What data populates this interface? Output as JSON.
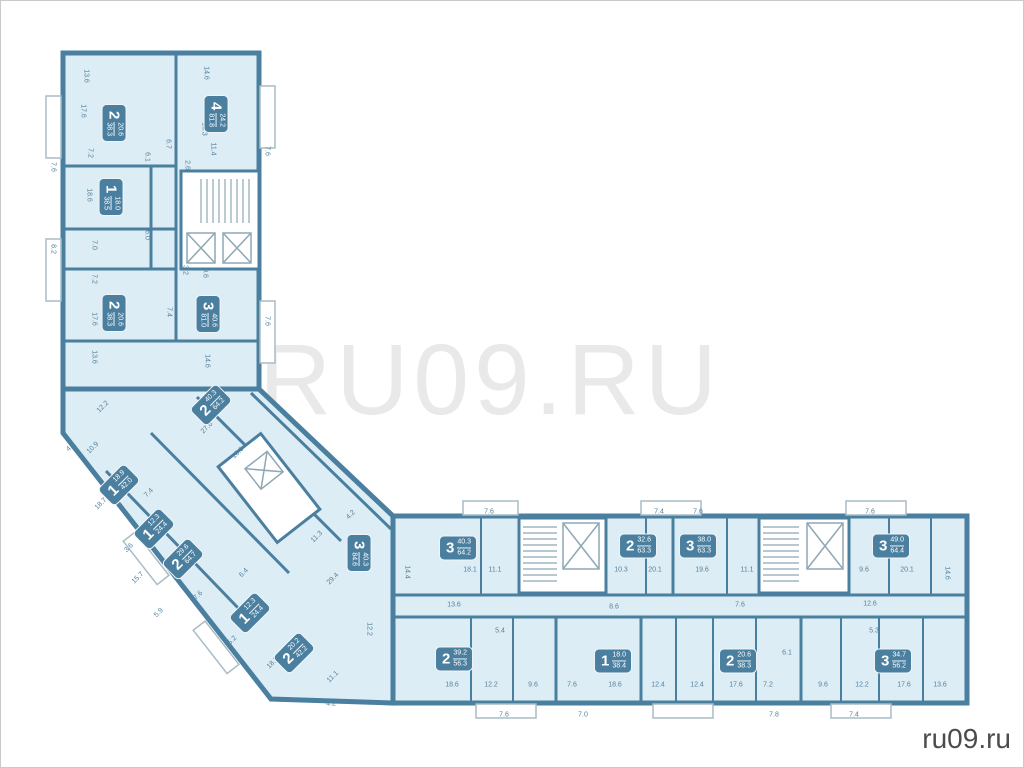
{
  "page": {
    "watermark": "RU09.RU",
    "site_label": "ru09.ru"
  },
  "colors": {
    "wall": "#4a7f9f",
    "apartment_fill": "#ddedf5",
    "badge_fill": "#4a7f9f",
    "badge_text": "#ffffff",
    "dimension_text": "#54809c",
    "balcony_stroke": "#a9bcc6",
    "watermark": "#e9e9e9",
    "site_text": "#4c4c4c"
  },
  "apartments": [
    {
      "rooms": "2",
      "a1": "20.6",
      "a2": "38.3",
      "x": 113,
      "y": 122,
      "rot": 90
    },
    {
      "rooms": "4",
      "a1": "24.2",
      "a2": "81.8",
      "x": 215,
      "y": 113,
      "rot": 90
    },
    {
      "rooms": "1",
      "a1": "18.0",
      "a2": "38.5",
      "x": 110,
      "y": 196,
      "rot": 90
    },
    {
      "rooms": "2",
      "a1": "20.6",
      "a2": "38.3",
      "x": 113,
      "y": 312,
      "rot": 90
    },
    {
      "rooms": "3",
      "a1": "40.6",
      "a2": "81.0",
      "x": 207,
      "y": 313,
      "rot": 90
    },
    {
      "rooms": "2",
      "a1": "40.3",
      "a2": "64.2",
      "x": 210,
      "y": 404,
      "rot": -45
    },
    {
      "rooms": "1",
      "a1": "18.9",
      "a2": "42.0",
      "x": 118,
      "y": 484,
      "rot": -45
    },
    {
      "rooms": "1",
      "a1": "12.3",
      "a2": "24.4",
      "x": 153,
      "y": 528,
      "rot": -45
    },
    {
      "rooms": "2",
      "a1": "29.6",
      "a2": "64.7",
      "x": 182,
      "y": 558,
      "rot": -45
    },
    {
      "rooms": "1",
      "a1": "12.3",
      "a2": "24.4",
      "x": 249,
      "y": 612,
      "rot": -45
    },
    {
      "rooms": "2",
      "a1": "20.2",
      "a2": "42.2",
      "x": 293,
      "y": 652,
      "rot": -45
    },
    {
      "rooms": "3",
      "a1": "40.3",
      "a2": "84.6",
      "x": 358,
      "y": 552,
      "rot": 90
    },
    {
      "rooms": "3",
      "a1": "40.3",
      "a2": "64.2",
      "x": 457,
      "y": 547,
      "rot": 0
    },
    {
      "rooms": "2",
      "a1": "32.6",
      "a2": "63.3",
      "x": 637,
      "y": 545,
      "rot": 0
    },
    {
      "rooms": "3",
      "a1": "38.0",
      "a2": "63.3",
      "x": 697,
      "y": 545,
      "rot": 0
    },
    {
      "rooms": "3",
      "a1": "49.0",
      "a2": "64.4",
      "x": 890,
      "y": 545,
      "rot": 0
    },
    {
      "rooms": "2",
      "a1": "39.2",
      "a2": "56.3",
      "x": 453,
      "y": 658,
      "rot": 0
    },
    {
      "rooms": "1",
      "a1": "18.0",
      "a2": "38.4",
      "x": 612,
      "y": 660,
      "rot": 0
    },
    {
      "rooms": "2",
      "a1": "20.6",
      "a2": "38.3",
      "x": 737,
      "y": 660,
      "rot": 0
    },
    {
      "rooms": "3",
      "a1": "34.7",
      "a2": "56.2",
      "x": 892,
      "y": 660,
      "rot": 0
    }
  ],
  "room_labels": [
    {
      "text": "13.6",
      "x": 85,
      "y": 75,
      "rot": 90
    },
    {
      "text": "14.6",
      "x": 205,
      "y": 72,
      "rot": 90
    },
    {
      "text": "17.6",
      "x": 82,
      "y": 110,
      "rot": 90
    },
    {
      "text": "10.3",
      "x": 203,
      "y": 128,
      "rot": 90
    },
    {
      "text": "11.4",
      "x": 212,
      "y": 148,
      "rot": 90
    },
    {
      "text": "7.2",
      "x": 89,
      "y": 152,
      "rot": 90
    },
    {
      "text": "6.7",
      "x": 167,
      "y": 143,
      "rot": 90
    },
    {
      "text": "2.6",
      "x": 186,
      "y": 164,
      "rot": 90
    },
    {
      "text": "6.1",
      "x": 146,
      "y": 156,
      "rot": 90
    },
    {
      "text": "18.6",
      "x": 88,
      "y": 194,
      "rot": 90
    },
    {
      "text": "6.0",
      "x": 146,
      "y": 234,
      "rot": 90
    },
    {
      "text": "7.0",
      "x": 93,
      "y": 244,
      "rot": 90
    },
    {
      "text": "3.2",
      "x": 184,
      "y": 269,
      "rot": 90
    },
    {
      "text": "9.6",
      "x": 204,
      "y": 272,
      "rot": 90
    },
    {
      "text": "7.2",
      "x": 93,
      "y": 278,
      "rot": 90
    },
    {
      "text": "20.1",
      "x": 204,
      "y": 308,
      "rot": 90
    },
    {
      "text": "17.6",
      "x": 93,
      "y": 318,
      "rot": 90
    },
    {
      "text": "7.4",
      "x": 168,
      "y": 311,
      "rot": 90
    },
    {
      "text": "13.6",
      "x": 93,
      "y": 356,
      "rot": 90
    },
    {
      "text": "14.6",
      "x": 206,
      "y": 360,
      "rot": 90
    },
    {
      "text": "7.6",
      "x": 52,
      "y": 166,
      "rot": 90
    },
    {
      "text": "8.2",
      "x": 52,
      "y": 248,
      "rot": 90
    },
    {
      "text": "7.6",
      "x": 266,
      "y": 150,
      "rot": 90
    },
    {
      "text": "7.6",
      "x": 266,
      "y": 320,
      "rot": 90
    },
    {
      "text": "12.2",
      "x": 102,
      "y": 406,
      "rot": -45
    },
    {
      "text": "10.9",
      "x": 92,
      "y": 447,
      "rot": -45
    },
    {
      "text": "27.6",
      "x": 206,
      "y": 427,
      "rot": -45
    },
    {
      "text": "10.6",
      "x": 237,
      "y": 452,
      "rot": -45
    },
    {
      "text": "4.7",
      "x": 70,
      "y": 446,
      "rot": -45
    },
    {
      "text": "7.4",
      "x": 148,
      "y": 492,
      "rot": -45
    },
    {
      "text": "18.7",
      "x": 100,
      "y": 503,
      "rot": -45
    },
    {
      "text": "15.7",
      "x": 137,
      "y": 577,
      "rot": -45
    },
    {
      "text": "3.6",
      "x": 128,
      "y": 547,
      "rot": -45
    },
    {
      "text": "5.9",
      "x": 158,
      "y": 612,
      "rot": -45
    },
    {
      "text": "17.6",
      "x": 196,
      "y": 596,
      "rot": -45
    },
    {
      "text": "15.2",
      "x": 230,
      "y": 641,
      "rot": -45
    },
    {
      "text": "6.4",
      "x": 243,
      "y": 572,
      "rot": -45
    },
    {
      "text": "18.5",
      "x": 272,
      "y": 662,
      "rot": -45
    },
    {
      "text": "29.4",
      "x": 332,
      "y": 578,
      "rot": -45
    },
    {
      "text": "11.3",
      "x": 316,
      "y": 536,
      "rot": -45
    },
    {
      "text": "12.2",
      "x": 368,
      "y": 628,
      "rot": 90
    },
    {
      "text": "11.1",
      "x": 332,
      "y": 676,
      "rot": -45
    },
    {
      "text": "4.2",
      "x": 330,
      "y": 703,
      "rot": 0
    },
    {
      "text": "4.2",
      "x": 350,
      "y": 514,
      "rot": -45
    },
    {
      "text": "14.4",
      "x": 406,
      "y": 571,
      "rot": 90
    },
    {
      "text": "18.1",
      "x": 469,
      "y": 569,
      "rot": 0
    },
    {
      "text": "11.1",
      "x": 494,
      "y": 569,
      "rot": 0
    },
    {
      "text": "13.6",
      "x": 453,
      "y": 604,
      "rot": 0
    },
    {
      "text": "10.3",
      "x": 620,
      "y": 569,
      "rot": 0
    },
    {
      "text": "20.1",
      "x": 654,
      "y": 569,
      "rot": 0
    },
    {
      "text": "8.6",
      "x": 613,
      "y": 606,
      "rot": 0
    },
    {
      "text": "19.6",
      "x": 701,
      "y": 569,
      "rot": 0
    },
    {
      "text": "11.1",
      "x": 746,
      "y": 569,
      "rot": 0
    },
    {
      "text": "7.6",
      "x": 739,
      "y": 604,
      "rot": 0
    },
    {
      "text": "9.6",
      "x": 863,
      "y": 569,
      "rot": 0
    },
    {
      "text": "20.1",
      "x": 906,
      "y": 569,
      "rot": 0
    },
    {
      "text": "12.6",
      "x": 869,
      "y": 603,
      "rot": 0
    },
    {
      "text": "14.6",
      "x": 946,
      "y": 572,
      "rot": 90
    },
    {
      "text": "7.6",
      "x": 488,
      "y": 511,
      "rot": 0
    },
    {
      "text": "7.4",
      "x": 658,
      "y": 511,
      "rot": 0
    },
    {
      "text": "7.6",
      "x": 697,
      "y": 511,
      "rot": 0
    },
    {
      "text": "7.6",
      "x": 869,
      "y": 511,
      "rot": 0
    },
    {
      "text": "5.4",
      "x": 499,
      "y": 630,
      "rot": 0
    },
    {
      "text": "18.6",
      "x": 451,
      "y": 684,
      "rot": 0
    },
    {
      "text": "12.2",
      "x": 490,
      "y": 684,
      "rot": 0
    },
    {
      "text": "9.6",
      "x": 532,
      "y": 684,
      "rot": 0
    },
    {
      "text": "7.6",
      "x": 571,
      "y": 684,
      "rot": 0
    },
    {
      "text": "18.6",
      "x": 614,
      "y": 684,
      "rot": 0
    },
    {
      "text": "12.4",
      "x": 657,
      "y": 684,
      "rot": 0
    },
    {
      "text": "12.4",
      "x": 696,
      "y": 684,
      "rot": 0
    },
    {
      "text": "17.6",
      "x": 735,
      "y": 684,
      "rot": 0
    },
    {
      "text": "7.2",
      "x": 767,
      "y": 684,
      "rot": 0
    },
    {
      "text": "6.1",
      "x": 786,
      "y": 652,
      "rot": 0
    },
    {
      "text": "5.3",
      "x": 873,
      "y": 630,
      "rot": 0
    },
    {
      "text": "9.6",
      "x": 822,
      "y": 684,
      "rot": 0
    },
    {
      "text": "12.2",
      "x": 861,
      "y": 684,
      "rot": 0
    },
    {
      "text": "17.6",
      "x": 903,
      "y": 684,
      "rot": 0
    },
    {
      "text": "13.6",
      "x": 939,
      "y": 684,
      "rot": 0
    },
    {
      "text": "7.6",
      "x": 503,
      "y": 714,
      "rot": 0
    },
    {
      "text": "7.0",
      "x": 582,
      "y": 714,
      "rot": 0
    },
    {
      "text": "7.8",
      "x": 773,
      "y": 714,
      "rot": 0
    },
    {
      "text": "7.4",
      "x": 853,
      "y": 714,
      "rot": 0
    }
  ]
}
